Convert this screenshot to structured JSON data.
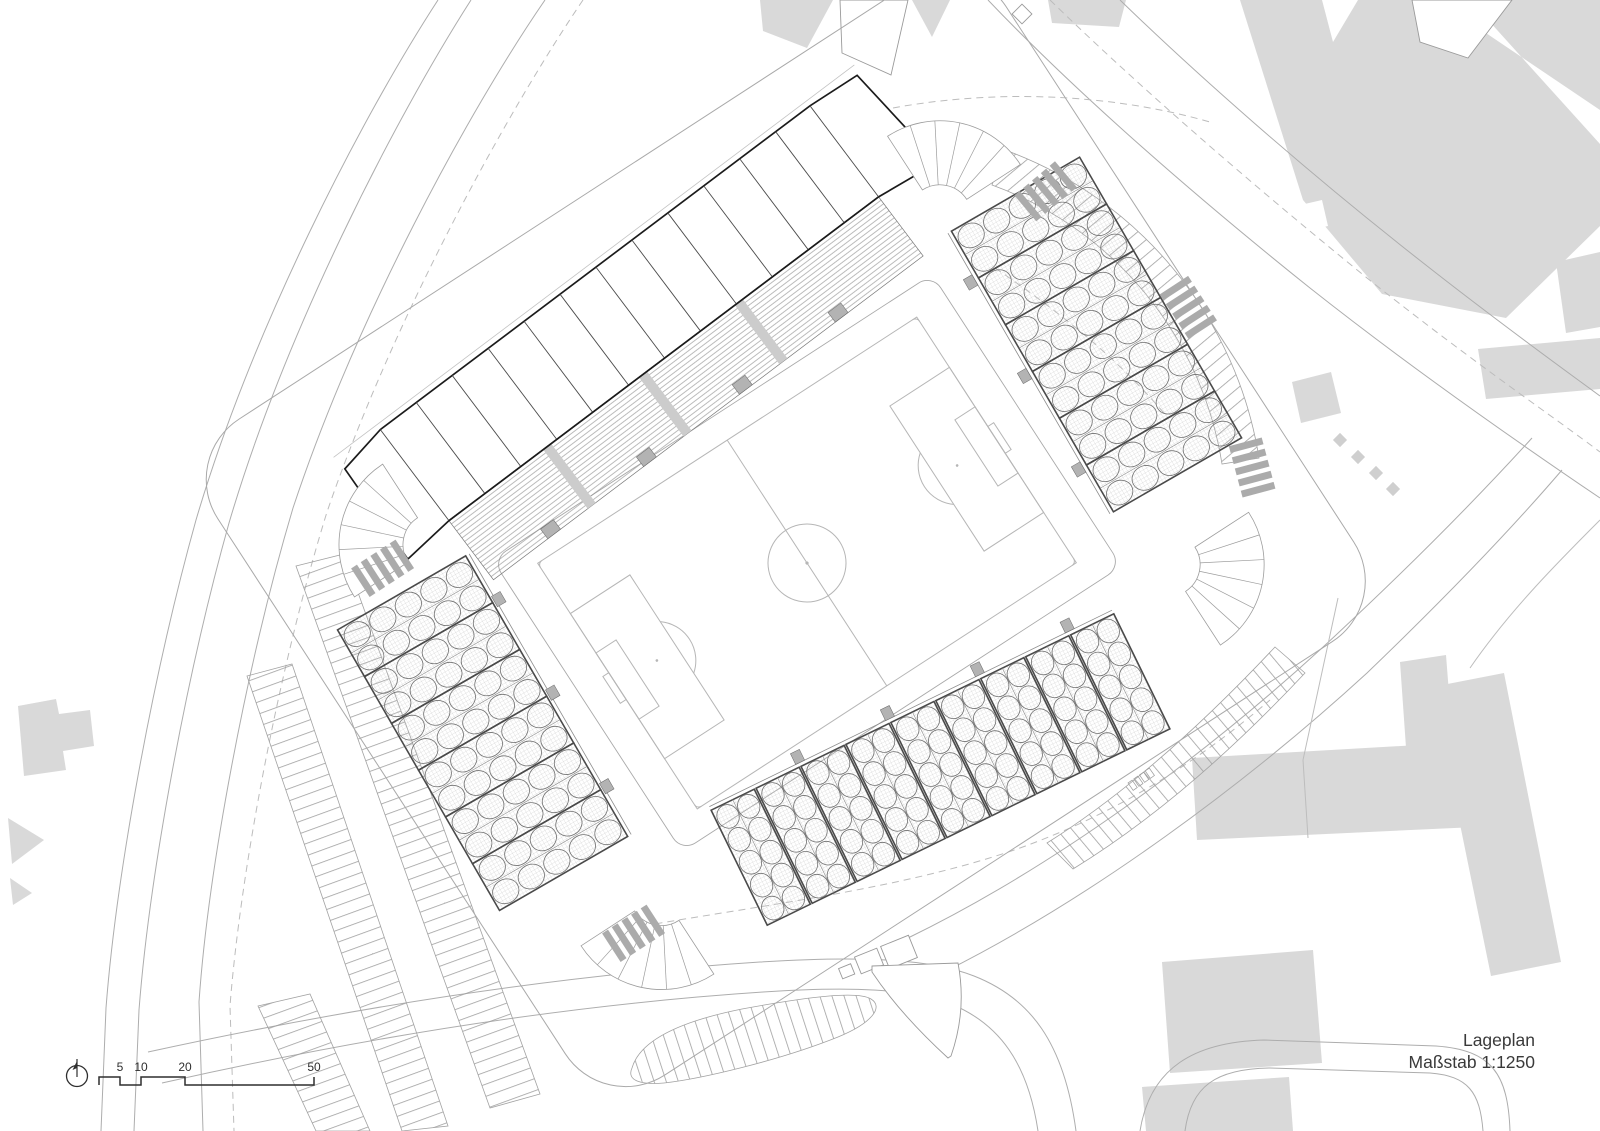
{
  "document": {
    "kind": "architectural site plan drawing",
    "subject": "stadium site plan with football pitch, four stands, parking areas and surrounding streets and buildings"
  },
  "title_block": {
    "line1": "Lageplan",
    "line2": "Maßstab 1:1250"
  },
  "scale_bar": {
    "unit": "m",
    "ticks": [
      "5",
      "10",
      "20",
      "50"
    ],
    "icon": "north-arrow-icon"
  },
  "colors": {
    "paper": "#ffffff",
    "building_fill": "#d9d9d9",
    "line_light": "#adadad",
    "line_medium": "#8c8c8c",
    "line_dark": "#1b1b1b",
    "vomitory_fill": "#b3b3b3",
    "crosswalk_fill": "#ababab",
    "text": "#3a3a3a"
  }
}
